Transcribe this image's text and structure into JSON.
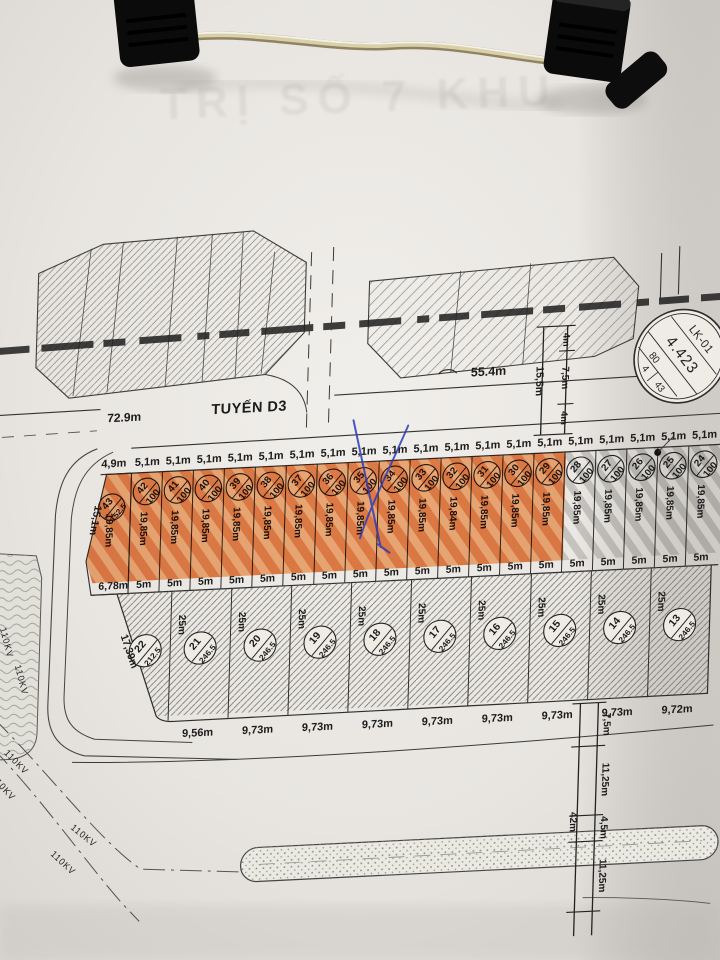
{
  "photo": {
    "paper_color": "#e9e6e2",
    "orange_highlight": "#ef7d2a",
    "pen_blue": "#2c3cb8",
    "ink": "#2b2b2b"
  },
  "ghost_text": "TRỊ SỐ 7 KHU",
  "main_road": {
    "length": "72.9m",
    "name": "TUYẾN D3",
    "curve_length": "55.4m"
  },
  "cross_section": {
    "total": "15,5m",
    "segments": [
      "4m",
      "7,5m",
      "4m"
    ]
  },
  "badge": {
    "code": "LK-01",
    "value": "4.423",
    "side": "80",
    "cells": [
      "4",
      "43"
    ]
  },
  "row_upper": {
    "plots": [
      {
        "no": "43",
        "area": "152.5",
        "w": "4,9m",
        "b": "6,78m",
        "d": "19,85m",
        "hl": true,
        "side": "15,1m"
      },
      {
        "no": "42",
        "area": "100",
        "w": "5,1m",
        "b": "5m",
        "d": "19,85m",
        "hl": true
      },
      {
        "no": "41",
        "area": "100",
        "w": "5,1m",
        "b": "5m",
        "d": "19,85m",
        "hl": true
      },
      {
        "no": "40",
        "area": "100",
        "w": "5,1m",
        "b": "5m",
        "d": "19,85m",
        "hl": true
      },
      {
        "no": "39",
        "area": "100",
        "w": "5,1m",
        "b": "5m",
        "d": "19,85m",
        "hl": true
      },
      {
        "no": "38",
        "area": "100",
        "w": "5,1m",
        "b": "5m",
        "d": "19,85m",
        "hl": true
      },
      {
        "no": "37",
        "area": "100",
        "w": "5,1m",
        "b": "5m",
        "d": "19,85m",
        "hl": true
      },
      {
        "no": "36",
        "area": "100",
        "w": "5,1m",
        "b": "5m",
        "d": "19,85m",
        "hl": true
      },
      {
        "no": "35",
        "area": "100",
        "w": "5,1m",
        "b": "5m",
        "d": "19,85m",
        "hl": true
      },
      {
        "no": "34",
        "area": "100",
        "w": "5,1m",
        "b": "5m",
        "d": "19,85m",
        "hl": true
      },
      {
        "no": "33",
        "area": "100",
        "w": "5,1m",
        "b": "5m",
        "d": "19,85m",
        "hl": true
      },
      {
        "no": "32",
        "area": "100",
        "w": "5,1m",
        "b": "5m",
        "d": "19,84m",
        "hl": true
      },
      {
        "no": "31",
        "area": "100",
        "w": "5,1m",
        "b": "5m",
        "d": "19,85m",
        "hl": true
      },
      {
        "no": "30",
        "area": "100",
        "w": "5,1m",
        "b": "5m",
        "d": "19,85m",
        "hl": true
      },
      {
        "no": "29",
        "area": "100",
        "w": "5,1m",
        "b": "5m",
        "d": "19,85m",
        "hl": true
      },
      {
        "no": "28",
        "area": "100",
        "w": "5,1m",
        "b": "5m",
        "d": "19,85m",
        "hl": false
      },
      {
        "no": "27",
        "area": "100",
        "w": "5,1m",
        "b": "5m",
        "d": "19,85m",
        "hl": false
      },
      {
        "no": "26",
        "area": "100",
        "w": "5,1m",
        "b": "5m",
        "d": "19,85m",
        "hl": false
      },
      {
        "no": "25",
        "area": "100",
        "w": "5,1m",
        "b": "5m",
        "d": "19,85m",
        "hl": false
      },
      {
        "no": "24",
        "area": "100",
        "w": "5,1m",
        "b": "5m",
        "d": "19,85m",
        "hl": false
      }
    ]
  },
  "row_lower": {
    "plots": [
      {
        "no": "22",
        "area": "212.5",
        "b": "",
        "d": "25m",
        "side": "17,39m"
      },
      {
        "no": "21",
        "area": "246.5",
        "b": "9,56m",
        "d": "25m"
      },
      {
        "no": "20",
        "area": "246.5",
        "b": "9,73m",
        "d": "25m"
      },
      {
        "no": "19",
        "area": "246.5",
        "b": "9,73m",
        "d": "25m"
      },
      {
        "no": "18",
        "area": "246.5",
        "b": "9,73m",
        "d": "25m"
      },
      {
        "no": "17",
        "area": "246.5",
        "b": "9,73m",
        "d": "25m"
      },
      {
        "no": "16",
        "area": "246.5",
        "b": "9,73m",
        "d": "25m"
      },
      {
        "no": "15",
        "area": "246.5",
        "b": "9,73m",
        "d": "25m"
      },
      {
        "no": "14",
        "area": "246.5",
        "b": "9,73m",
        "d": "25m"
      },
      {
        "no": "13",
        "area": "246.5",
        "b": "9,72m",
        "d": "25m"
      }
    ]
  },
  "east_dims": {
    "total": "42m",
    "segments": [
      "7,5m",
      "11,25m",
      "4,5m",
      "11,25m"
    ]
  },
  "power_line": {
    "label": "110KV"
  }
}
